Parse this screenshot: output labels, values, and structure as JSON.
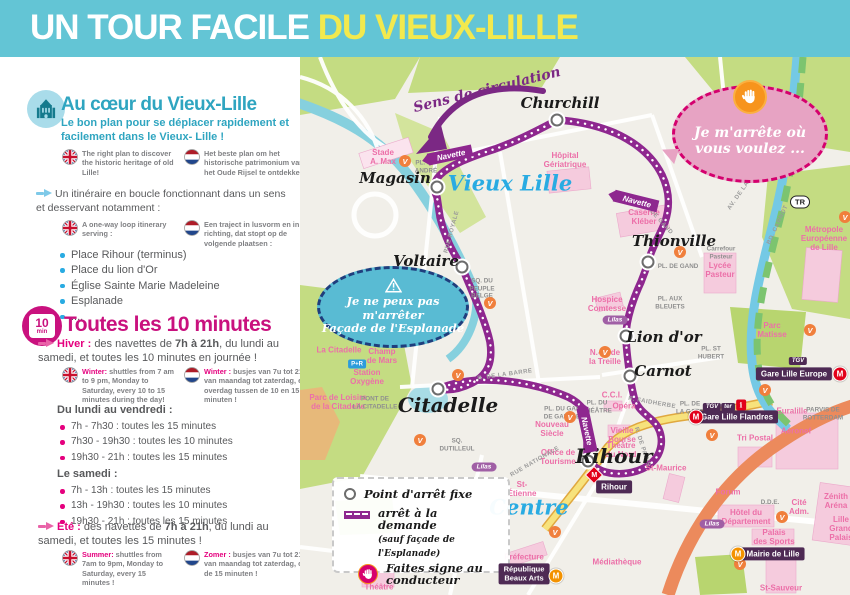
{
  "colors": {
    "header_bg": "#63C5D5",
    "header_yellow": "#F2E94E",
    "teal": "#2FA5C0",
    "magenta": "#C9117E",
    "pink": "#E5007E",
    "text_gray": "#58595B",
    "route_purple": "#8E278F",
    "badge_purple": "#4E2A54",
    "blue_label": "#29ABE2"
  },
  "header": {
    "title_part1": "UN TOUR FACILE ",
    "title_part2": "DU VIEUX-LILLE"
  },
  "sidebar": {
    "section1": {
      "heading": "Au cœur du Vieux-Lille",
      "intro": "Le bon plan pour se déplacer rapidement et facilement dans le Vieux- Lille !",
      "flag_en": "The right plan to discover the historic heritage of old Lille!",
      "flag_nl": "Het beste plan om het historische patrimonium van het Oude Rijsel te ontdekken !",
      "loop_fr": "Un itinéraire en boucle fonctionnant dans un sens et desservant notamment  :",
      "loop_en": "A one-way loop itinerary serving :",
      "loop_nl": "Een traject in lusvorm en in één richting, dat stopt op de volgende plaatsen :",
      "stops": [
        "Place Rihour (terminus)",
        "Place du lion d'Or",
        "Église Sainte Marie Madeleine",
        "Esplanade",
        "...."
      ]
    },
    "section2": {
      "badge_value": "10",
      "badge_unit": "min",
      "heading": "Toutes les 10 minutes",
      "hiver_label": "Hiver :",
      "hiver_pre": "des navettes de ",
      "hiver_bold": "7h à 21h",
      "hiver_post": ", du lundi au samedi, et toutes les 10 minutes en journée !",
      "winter_en_label": "Winter:",
      "winter_en": "shuttles from 7 am to 9 pm, Monday to Saturday, every 10 to 15 minutes during the day!",
      "winter_nl_label": "Winter :",
      "winter_nl": "busjes van 7u tot 21u, van maandag tot zaterdag, en overdag tussen de 10 en 15 minuten !",
      "weekdays_heading": "Du lundi au vendredi :",
      "weekdays": [
        "7h - 7h30 : toutes les 15 minutes",
        "7h30 - 19h30 : toutes les 10 minutes",
        "19h30 - 21h : toutes les 15 minutes"
      ],
      "saturday_heading": "Le samedi :",
      "saturday": [
        "7h - 13h : toutes les 15 minutes",
        "13h - 19h30 : toutes les 10 minutes",
        "19h30 - 21h : toutes les 15 minutes"
      ],
      "ete_label": "Été :",
      "ete_pre": "des navettes de ",
      "ete_bold": "7h à 21h",
      "ete_post": ", du lundi au samedi, et toutes les 15 minutes !",
      "summer_en_label": "Summer:",
      "summer_en": "shuttles from 7am to 9pm, Monday to Saturday, every 15 minutes !",
      "summer_nl_label": "Zomer :",
      "summer_nl": "busjes van 7u tot 21u, van maandag tot zaterdag, om de 15 minuten !"
    }
  },
  "map": {
    "direction_label": "Sens de circulation",
    "navette_label": "Navette",
    "district_labels": [
      {
        "text": "Vieux Lille"
      },
      {
        "text": "Centre"
      }
    ],
    "bubbles": {
      "demand_line1": "Je m'arrête où",
      "demand_line2": "vous voulez ...",
      "nostop_line1": "Je ne peux pas m'arrêter",
      "nostop_line2": "Façade de l'Esplanade"
    },
    "legend": {
      "fixed": "Point d'arrêt fixe",
      "demand1": "arrêt à la demande",
      "demand2": "(sauf façade de l'Esplanade)",
      "wave": "Faites signe au conducteur"
    },
    "badges": {
      "gare_europe": "Gare Lille Europe",
      "gare_flandres": "Gare Lille Flandres",
      "rihour": "Rihour",
      "republique_1": "République",
      "republique_2": "Beaux Arts",
      "mairie": "Mairie de Lille"
    },
    "transit": {
      "tgv": "TGV",
      "ter": "ter",
      "info": "i",
      "tr": "TR",
      "pr": "P+R",
      "metro": "M",
      "lilas": "Lilas"
    },
    "stops": [
      {
        "name": "Churchill",
        "cx": 257,
        "cy": 63,
        "lx": 260,
        "ly": 46,
        "big": 0
      },
      {
        "name": "Magasin",
        "cx": 137,
        "cy": 130,
        "lx": 95,
        "ly": 121,
        "big": 0
      },
      {
        "name": "Voltaire",
        "cx": 162,
        "cy": 210,
        "lx": 126,
        "ly": 204,
        "big": 0
      },
      {
        "name": "Thionville",
        "cx": 348,
        "cy": 205,
        "lx": 374,
        "ly": 184,
        "big": 0
      },
      {
        "name": "Lion d'or",
        "cx": 326,
        "cy": 279,
        "lx": 364,
        "ly": 280,
        "big": 0
      },
      {
        "name": "Carnot",
        "cx": 330,
        "cy": 319,
        "lx": 363,
        "ly": 314,
        "big": 0
      },
      {
        "name": "Citadelle",
        "cx": 138,
        "cy": 332,
        "lx": 148,
        "ly": 348,
        "big": 1
      },
      {
        "name": "Rihour",
        "cx": 288,
        "cy": 404,
        "lx": 314,
        "ly": 399,
        "big": 1
      }
    ],
    "pink_labels": [
      {
        "text": "Stade|A. Max",
        "x": 83,
        "y": 100
      },
      {
        "text": "Hôpital|Gériatrique",
        "x": 265,
        "y": 103
      },
      {
        "text": "Caserne|Kléber",
        "x": 344,
        "y": 160
      },
      {
        "text": "Lycée|Pasteur",
        "x": 420,
        "y": 213
      },
      {
        "text": "Métropole|Européenne|de Lille",
        "x": 524,
        "y": 182
      },
      {
        "text": "Parc|Matisse",
        "x": 472,
        "y": 273
      },
      {
        "text": "Hospice|Comtesse",
        "x": 307,
        "y": 247
      },
      {
        "text": "N.-D. de|la Treille",
        "x": 305,
        "y": 300
      },
      {
        "text": "La Citadelle",
        "x": 39,
        "y": 293
      },
      {
        "text": "Champ|de Mars",
        "x": 82,
        "y": 299
      },
      {
        "text": "Station|Oxygène",
        "x": 67,
        "y": 320
      },
      {
        "text": "Parc de Loisirs|de la Citadelle",
        "x": 38,
        "y": 345
      },
      {
        "text": "Opéra",
        "x": 324,
        "y": 349
      },
      {
        "text": "Vieille|Bourse",
        "x": 322,
        "y": 378
      },
      {
        "text": "Théâtre|du Nord",
        "x": 321,
        "y": 393
      },
      {
        "text": "Office de|Tourisme",
        "x": 258,
        "y": 400
      },
      {
        "text": "St-Maurice",
        "x": 366,
        "y": 411
      },
      {
        "text": "St-|Étienne",
        "x": 222,
        "y": 432
      },
      {
        "text": "Nouveau|Siècle",
        "x": 252,
        "y": 372
      },
      {
        "text": "Préfecture",
        "x": 224,
        "y": 500
      },
      {
        "text": "Théâtre",
        "x": 79,
        "y": 530
      },
      {
        "text": "Médiathèque",
        "x": 317,
        "y": 505
      },
      {
        "text": "Euralille",
        "x": 492,
        "y": 354
      },
      {
        "text": "Aéronef",
        "x": 496,
        "y": 374
      },
      {
        "text": "Tri Postal",
        "x": 455,
        "y": 381
      },
      {
        "text": "Forum",
        "x": 428,
        "y": 435
      },
      {
        "text": "Hôtel du|Département",
        "x": 446,
        "y": 460
      },
      {
        "text": "Cité|Adm.",
        "x": 499,
        "y": 450
      },
      {
        "text": "Palais|des Sports",
        "x": 474,
        "y": 480
      },
      {
        "text": "St-Sauveur",
        "x": 481,
        "y": 531
      },
      {
        "text": "Zénith|Aréna",
        "x": 536,
        "y": 444
      },
      {
        "text": "Lille|Grand Palais",
        "x": 541,
        "y": 472
      },
      {
        "text": "C.C.I.",
        "x": 312,
        "y": 338
      }
    ],
    "gray_labels": [
      {
        "text": "Carrefour|Pasteur",
        "x": 421,
        "y": 196
      },
      {
        "text": "PL. DE GAND",
        "x": 378,
        "y": 210
      },
      {
        "text": "PL. AUX|BLEUETS",
        "x": 370,
        "y": 246
      },
      {
        "text": "PONT DE|LA CITADELLE",
        "x": 75,
        "y": 346
      },
      {
        "text": "PL. DU GAL|DE GAULLE",
        "x": 262,
        "y": 356
      },
      {
        "text": "PL. ST|HUBERT",
        "x": 411,
        "y": 296
      },
      {
        "text": "PL. DE|LA GARE",
        "x": 390,
        "y": 351
      },
      {
        "text": "PARVIS DE|ROTTERDAM",
        "x": 523,
        "y": 357
      },
      {
        "text": "SQ. DU|PEUPLE|BELGE",
        "x": 182,
        "y": 232
      },
      {
        "text": "PL. ST-|ANDRÉ",
        "x": 126,
        "y": 110
      },
      {
        "text": "SQ.|DUTILLEUL",
        "x": 157,
        "y": 388
      },
      {
        "text": "D.D.E.",
        "x": 470,
        "y": 446
      },
      {
        "text": "PL. DU|THÉÂTRE",
        "x": 297,
        "y": 350
      }
    ],
    "street_labels": [
      {
        "text": "BD. CARNOT",
        "x": 478,
        "y": 168,
        "rot": -65
      },
      {
        "text": "AV. DE LA RÉPUBLIQUE",
        "x": 452,
        "y": 120,
        "rot": -55
      },
      {
        "text": "RUE ROYALE",
        "x": 152,
        "y": 175,
        "rot": -75
      },
      {
        "text": "R. DE LA BARRE",
        "x": 205,
        "y": 318,
        "rot": -8
      },
      {
        "text": "R. FAIDHERBE",
        "x": 352,
        "y": 346,
        "rot": 10
      },
      {
        "text": "R. DE PARIS",
        "x": 342,
        "y": 390,
        "rot": 72
      },
      {
        "text": "RUE NATIONALE",
        "x": 235,
        "y": 405,
        "rot": -30
      },
      {
        "text": "R. DE GAND",
        "x": 358,
        "y": 162,
        "rot": 48
      }
    ]
  }
}
